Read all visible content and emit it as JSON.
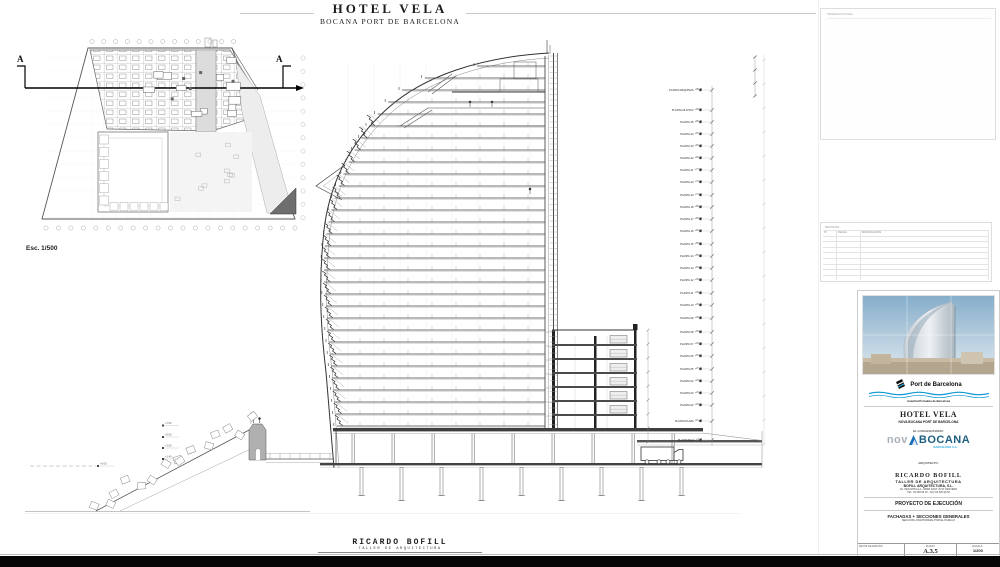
{
  "header": {
    "title": "HOTEL VELA",
    "subtitle": "BOCANA PORT DE BARCELONA"
  },
  "plan": {
    "scale_label": "Esc. 1/500",
    "section_letter": "A"
  },
  "section": {
    "left_markers": [
      "+7.50",
      "+5.00",
      "+2.50",
      "+1.40",
      "+0.00"
    ],
    "floors": [
      {
        "label": "PLANTA MAQUINAS",
        "elev": "+98.75",
        "y": 90
      },
      {
        "label": "PLANTA 26 ATICO",
        "elev": "+93.60",
        "y": 110
      },
      {
        "label": "PLANTA 25",
        "elev": "+90.45",
        "y": 122
      },
      {
        "label": "PLANTA 24",
        "elev": "+87.30",
        "y": 134
      },
      {
        "label": "PLANTA 23",
        "elev": "+84.15",
        "y": 146
      },
      {
        "label": "PLANTA 22",
        "elev": "+81.00",
        "y": 158
      },
      {
        "label": "PLANTA 21",
        "elev": "+77.85",
        "y": 170
      },
      {
        "label": "PLANTA 20",
        "elev": "+74.70",
        "y": 182
      },
      {
        "label": "PLANTA 19",
        "elev": "+71.55",
        "y": 195
      },
      {
        "label": "PLANTA 18",
        "elev": "+68.40",
        "y": 207
      },
      {
        "label": "PLANTA 17",
        "elev": "+65.25",
        "y": 219
      },
      {
        "label": "PLANTA 16",
        "elev": "+62.10",
        "y": 231
      },
      {
        "label": "PLANTA 15",
        "elev": "+58.95",
        "y": 244
      },
      {
        "label": "PLANTA 14",
        "elev": "+55.80",
        "y": 256
      },
      {
        "label": "PLANTA 13",
        "elev": "+52.65",
        "y": 268
      },
      {
        "label": "PLANTA 12",
        "elev": "+49.50",
        "y": 280
      },
      {
        "label": "PLANTA 11",
        "elev": "+46.35",
        "y": 293
      },
      {
        "label": "PLANTA 10",
        "elev": "+43.20",
        "y": 305
      },
      {
        "label": "PLANTA 09",
        "elev": "+40.05",
        "y": 318
      },
      {
        "label": "PLANTA 08",
        "elev": "+36.90",
        "y": 332
      },
      {
        "label": "PLANTA 07",
        "elev": "+33.75",
        "y": 344
      },
      {
        "label": "PLANTA 06",
        "elev": "+30.60",
        "y": 356
      },
      {
        "label": "PLANTA 05",
        "elev": "+27.45",
        "y": 369
      },
      {
        "label": "PLANTA 04",
        "elev": "+24.30",
        "y": 381
      },
      {
        "label": "PLANTA 03",
        "elev": "+21.15",
        "y": 393
      },
      {
        "label": "PLANTA 02",
        "elev": "+18.00",
        "y": 405
      },
      {
        "label": "PLANTA PLAZA",
        "elev": "+11.40",
        "y": 421
      },
      {
        "label": "PLANTA BAJA",
        "elev": "+4.20",
        "y": 440
      }
    ]
  },
  "notes_box": {
    "label": "OBSERVACIONES"
  },
  "revisions": {
    "title": "REVISION",
    "columns": [
      "Nº",
      "FECHA",
      "MODIFICACION"
    ],
    "empty_rows": 8
  },
  "titleblock": {
    "port_logo": {
      "name": "Port de Barcelona",
      "subtext": "Autoritat Portuària de Barcelona",
      "wave_color": "#1a9cd8"
    },
    "project_title": "HOTEL VELA",
    "project_subtitle": "NOVA BOCANA PORT DE BARCELONA",
    "concessionaire_label": "EL CONCESIONARIO:",
    "concessionaire_logo": {
      "part1": "nov",
      "part2": "BOCANA",
      "subtext": "BARCELONA S.A.",
      "gray": "#aab0b5",
      "dark": "#1e5f80",
      "accent": "#2aa9dd",
      "triangle": "#1d6eb8"
    },
    "architect_label": "ARQUITECTO:",
    "architect_name": "RICARDO BOFILL",
    "architect_line2": "TALLER DE ARQUITECTURA",
    "architect_line3": "BOFILL ARQUITECTURA, S.L.",
    "architect_line4": "AV. INDUSTRIA 14 - 08960 SANT JUST DESVERN",
    "architect_line5": "TEL. 93 499 99 00 - FAX 93 499 99 50",
    "phase": "PROYECTO DE EJECUCIÓN",
    "sheet_title": "FACHADAS + SECCIONES GENERALES",
    "sheet_subtitle": "SECCION LONGITUDINAL POR EL PASILLO",
    "fields": {
      "date_label": "FECHA DE EDICIÓN",
      "plano_label": "PLANO:",
      "plano_value": "A.3.5",
      "escala_label": "ESCALA:",
      "escala_value": "1/200"
    }
  },
  "footer": {
    "firm": "RICARDO BOFILL",
    "firm_sub": "TALLER DE ARQUITECTURA"
  }
}
